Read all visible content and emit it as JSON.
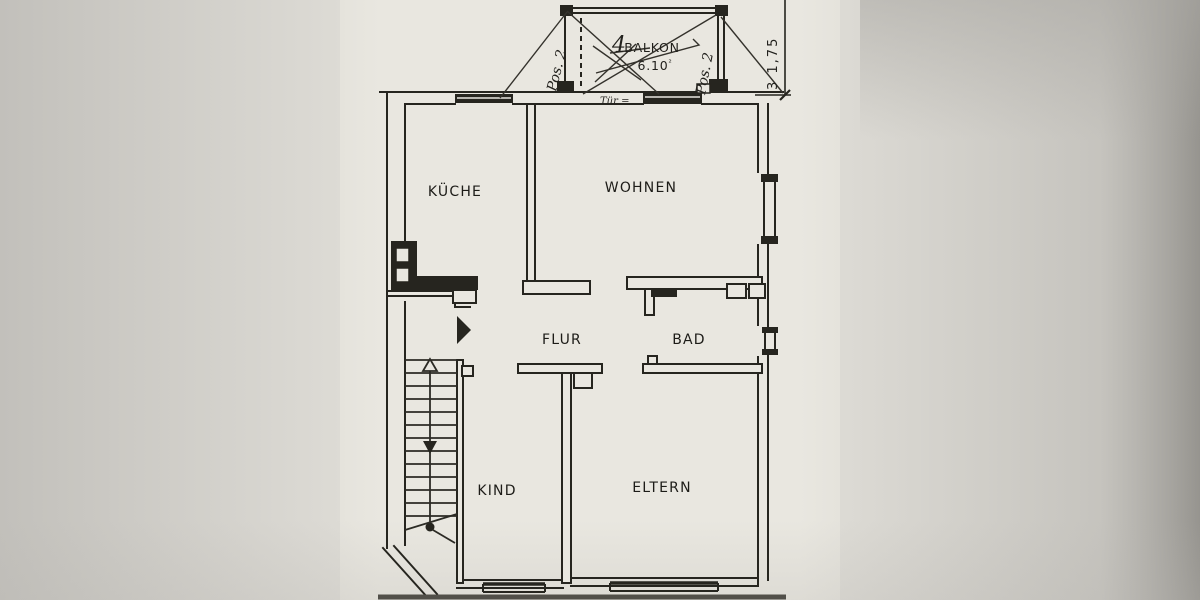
{
  "plan": {
    "rooms": {
      "kueche": "KÜCHE",
      "wohnen": "WOHNEN",
      "flur": "FLUR",
      "bad": "BAD",
      "kind": "KIND",
      "eltern": "ELTERN",
      "balkon": "BALKON"
    },
    "balcony": {
      "area": "6.10",
      "area_sup": "²",
      "handwritten_number": "4",
      "note_left": "Pos. 2",
      "note_right": "Pos. 2",
      "door_note": "Tür ="
    },
    "dimension_right": "3  1,75",
    "colors": {
      "ink": "#26251f",
      "paper": "#e9e7e0",
      "margin": "#c9c7c2"
    }
  }
}
